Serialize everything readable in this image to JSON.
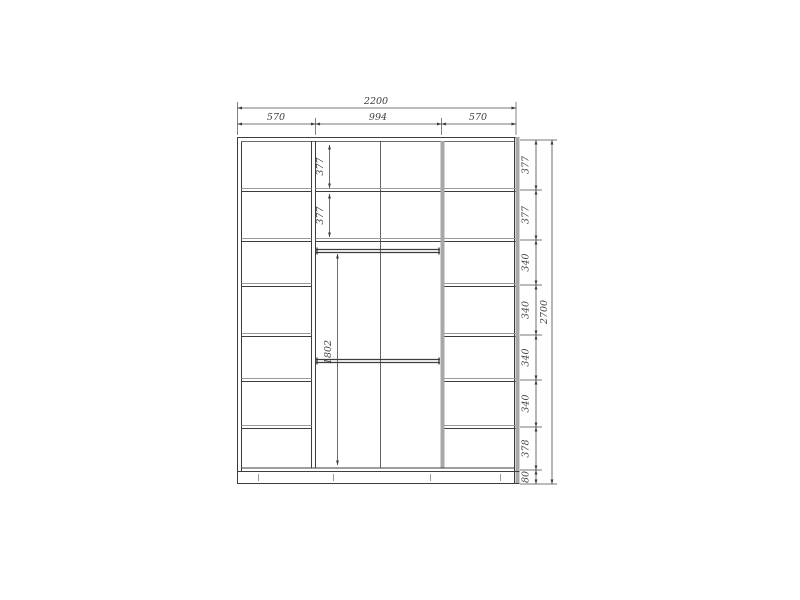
{
  "drawing": {
    "subject": "wardrobe-elevation-technical-drawing",
    "units": "mm"
  },
  "dims": {
    "top": {
      "total": "2200",
      "segments": [
        "570",
        "994",
        "570"
      ]
    },
    "right": {
      "total": "2700",
      "segments": [
        "377",
        "377",
        "340",
        "340",
        "340",
        "340",
        "378",
        "80"
      ]
    },
    "middle": {
      "shelf_heights": [
        "377",
        "377"
      ],
      "open_height": "1802"
    }
  },
  "colors": {
    "background": "#ffffff",
    "structure_line": "#3d3d3d",
    "highlight_panel": "#a8a8a8",
    "dimension_line": "#4a4a4a",
    "dimension_text": "#3f3f3f"
  }
}
